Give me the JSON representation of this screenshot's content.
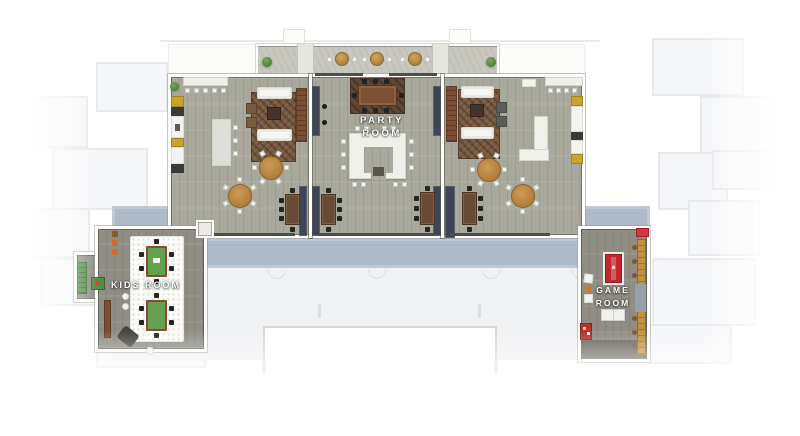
{
  "page": {
    "title": "Amenity Level Floor Plan"
  },
  "colors": {
    "floor-wood": "#a9a89c",
    "floor-wood-dark": "#8f8d84",
    "corridor-blue": "#aebac7",
    "terrace-gray": "#c8c8bf",
    "wall-white": "#fdfdfc",
    "navy-panel": "#3e4557",
    "sideboard-brown": "#7a4f33",
    "table-brown": "#6b4a33",
    "round-table-wood": "#bf8c49",
    "kids-green": "#63a04f",
    "game-red": "#c2272e",
    "cabinet-yellow": "#c8a42e",
    "rug-brown": "#78593f",
    "faded-fill": "#f4f5f7",
    "faded-line": "#e3e4e8"
  },
  "rooms": {
    "party_room": {
      "label": "PARTY ROOM"
    },
    "kids_room": {
      "label": "KIDS ROOM"
    },
    "game_room": {
      "label_line1": "GAME",
      "label_line2": "ROOM"
    }
  }
}
